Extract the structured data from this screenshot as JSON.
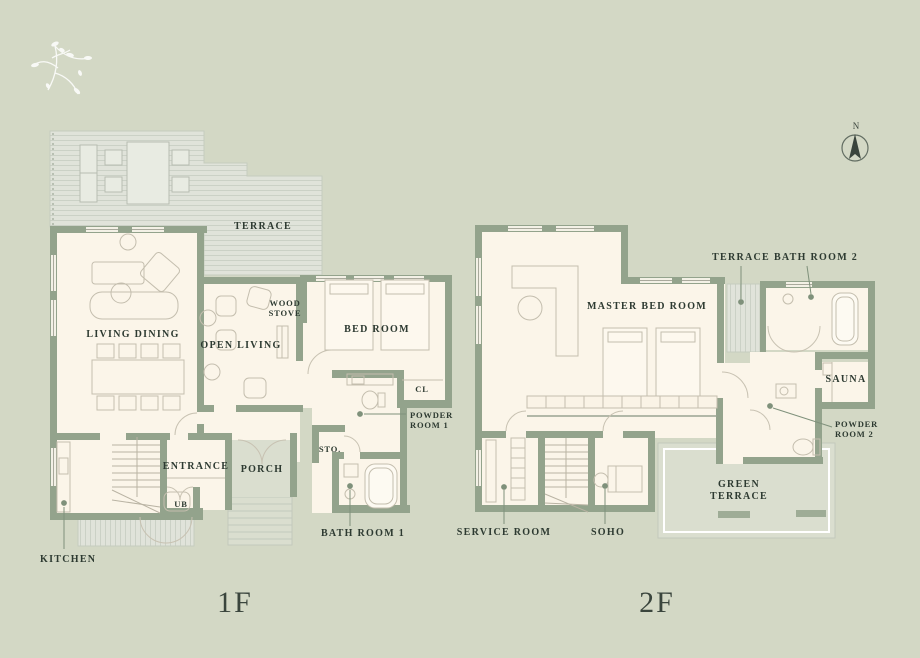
{
  "colors": {
    "background": "#d3d8c5",
    "wall": "#93a38c",
    "floor": "#fbf5e9",
    "deck": "#e0e3da",
    "deck_line": "#cbd1c6",
    "porch": "#dadecf",
    "furniture_line": "#c4beae",
    "text": "#2d3a31"
  },
  "compass": {
    "north_label": "N"
  },
  "floor1": {
    "title": "1F",
    "labels": {
      "terrace": "TERRACE",
      "living_dining": "LIVING DINING",
      "open_living": "OPEN LIVING",
      "wood_stove": "WOOD STOVE",
      "bed_room": "BED ROOM",
      "closet": "CL",
      "powder_room": "POWDER ROOM 1",
      "storage": "STO.",
      "entrance": "ENTRANCE",
      "porch": "PORCH",
      "unit_bath": "UB",
      "bath_room": "BATH ROOM 1",
      "kitchen": "KITCHEN"
    }
  },
  "floor2": {
    "title": "2F",
    "labels": {
      "terrace": "TERRACE",
      "bath_room": "BATH ROOM 2",
      "master_bed_room": "MASTER BED ROOM",
      "sauna": "SAUNA",
      "powder_room": "POWDER ROOM 2",
      "green_terrace": "GREEN TERRACE",
      "service_room": "SERVICE ROOM",
      "soho": "SOHO"
    }
  }
}
